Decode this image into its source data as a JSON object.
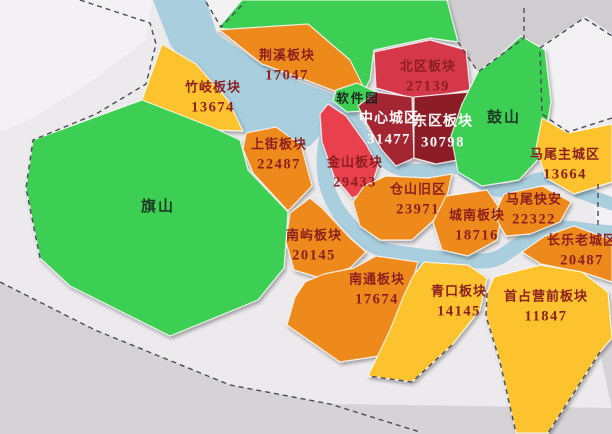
{
  "palette": {
    "base": "#eceaec",
    "gray": "#d6d3d6",
    "gray_dark": "#d0cdd0",
    "white": "#f3f1f3",
    "river": "#a9cede",
    "orange": "#ee8a1c",
    "yellow": "#fcc32d",
    "green": "#3ccf52",
    "red": "#d5394a",
    "red_bright": "#e8414e",
    "red_dark": "#a32531",
    "maroon": "#8c1b26",
    "dark_red": "#8b1e1e",
    "white_text": "#ffffff",
    "black": "#20261e",
    "mountain": "#1d3a25",
    "dash": "#4b4b55"
  },
  "map": {
    "regions": [
      {
        "id": "jingxi",
        "label": "荆溪板块",
        "value": "17047",
        "fill": "orange",
        "text": "dark_red"
      },
      {
        "id": "zhuqi",
        "label": "竹岐板块",
        "value": "13674",
        "fill": "yellow",
        "text": "dark_red"
      },
      {
        "id": "qishan",
        "label": "旗山",
        "value": "",
        "fill": "green",
        "text": "mountain"
      },
      {
        "id": "shangjie",
        "label": "上街板块",
        "value": "22487",
        "fill": "orange",
        "text": "dark_red"
      },
      {
        "id": "nanyu",
        "label": "南屿板块",
        "value": "20145",
        "fill": "orange",
        "text": "dark_red"
      },
      {
        "id": "jinshan",
        "label": "金山板块",
        "value": "29433",
        "fill": "red_bright",
        "text": "dark_red"
      },
      {
        "id": "ruanjianyuan",
        "label": "软件园",
        "value": "",
        "fill": "green",
        "text": "black"
      },
      {
        "id": "beiqu",
        "label": "北区板块",
        "value": "27139",
        "fill": "red",
        "text": "dark_red"
      },
      {
        "id": "zhongxin",
        "label": "中心城区",
        "value": "31477",
        "fill": "red_dark",
        "text": "white_text"
      },
      {
        "id": "dongqu",
        "label": "东区板块",
        "value": "30798",
        "fill": "maroon",
        "text": "white_text"
      },
      {
        "id": "gushan",
        "label": "鼓山",
        "value": "",
        "fill": "green",
        "text": "mountain"
      },
      {
        "id": "cangshan",
        "label": "仓山旧区",
        "value": "23971",
        "fill": "orange",
        "text": "dark_red"
      },
      {
        "id": "chengnan",
        "label": "城南板块",
        "value": "18716",
        "fill": "orange",
        "text": "dark_red"
      },
      {
        "id": "kuaian",
        "label": "马尾快安",
        "value": "22322",
        "fill": "orange",
        "text": "dark_red"
      },
      {
        "id": "mawei",
        "label": "马尾主城区",
        "value": "13664",
        "fill": "yellow",
        "text": "dark_red"
      },
      {
        "id": "changle",
        "label": "长乐老城区",
        "value": "20487",
        "fill": "orange",
        "text": "dark_red"
      },
      {
        "id": "nantong",
        "label": "南通板块",
        "value": "17674",
        "fill": "orange",
        "text": "dark_red"
      },
      {
        "id": "qingkou",
        "label": "青口板块",
        "value": "14145",
        "fill": "yellow",
        "text": "dark_red"
      },
      {
        "id": "shouzhan",
        "label": "首占营前板块",
        "value": "11847",
        "fill": "yellow",
        "text": "dark_red"
      }
    ]
  }
}
